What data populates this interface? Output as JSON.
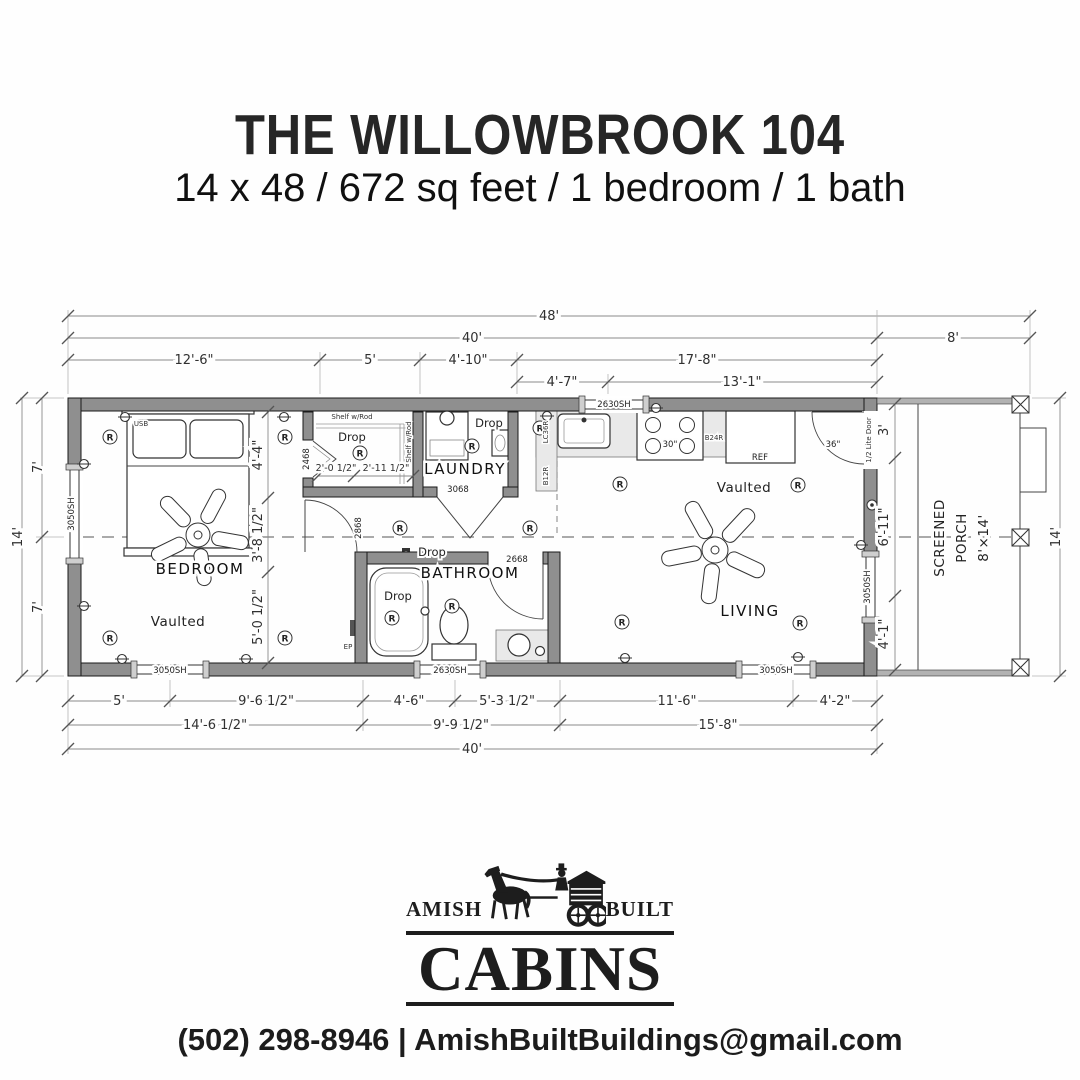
{
  "header": {
    "title": "THE WILLOWBROOK 104",
    "subtitle": "14 x 48 / 672 sq feet / 1 bedroom / 1 bath"
  },
  "plan": {
    "dims": {
      "overall_width": "48'",
      "main_width": "40'",
      "porch_width": "8'",
      "top_row3": [
        "12'-6\"",
        "5'",
        "4'-10\"",
        "17'-8\""
      ],
      "top_row4": [
        "4'-7\"",
        "13'-1\""
      ],
      "bottom_row1": [
        "5'",
        "9'-6 1/2\"",
        "4'-6\"",
        "5'-3 1/2\"",
        "11'-6\"",
        "4'-2\""
      ],
      "bottom_row2": [
        "14'-6 1/2\"",
        "9'-9 1/2\"",
        "15'-8\""
      ],
      "bottom_overall": "40'",
      "left_overall": "14'",
      "left_segments": [
        "7'",
        "7'"
      ],
      "right_overall": "14'",
      "porch_segments": [
        "3'",
        "6'-11\"",
        "4'-1\""
      ],
      "bedroom_segments": [
        "4'-4\"",
        "3'-8 1/2\"",
        "5'-0 1/2\""
      ],
      "closet_segments": [
        "2'-0 1/2\"",
        "2'-11 1/2\""
      ]
    },
    "rooms": {
      "bedroom": "BEDROOM",
      "bedroom_note": "Vaulted",
      "laundry": "LAUNDRY",
      "bathroom": "BATHROOM",
      "living": "LIVING",
      "living_note": "Vaulted",
      "porch_line1": "SCREENED",
      "porch_line2": "PORCH",
      "porch_line3": "8'×14'"
    },
    "windows": {
      "left": "3050SH",
      "bedroom_bottom": "3050SH",
      "bath_bottom": "2630SH",
      "living_bottom": "3050SH",
      "kitchen_top": "2630SH",
      "living_right": "3050SH"
    },
    "doors": {
      "closet": "2468",
      "laundry": "3068",
      "bedroom": "2868",
      "bathroom": "2668",
      "entry_width": "36\"",
      "entry_type": "1/2 Lite Door"
    },
    "fixtures": {
      "shelf": "Shelf w/Rod",
      "shelf_side": "Shelf w/Rod",
      "drop": "Drop",
      "ref": "REF",
      "range_width": "30\"",
      "cab_corner": "LC36R",
      "cab_base12": "B12R",
      "cab_base24": "B24R",
      "panel": "EP",
      "usb": "USB",
      "light": "R"
    }
  },
  "logo": {
    "word_left": "AMISH",
    "word_right": "BUILT",
    "word_main": "CABINS"
  },
  "footer": {
    "contact": "(502) 298-8946 | AmishBuiltBuildings@gmail.com"
  }
}
